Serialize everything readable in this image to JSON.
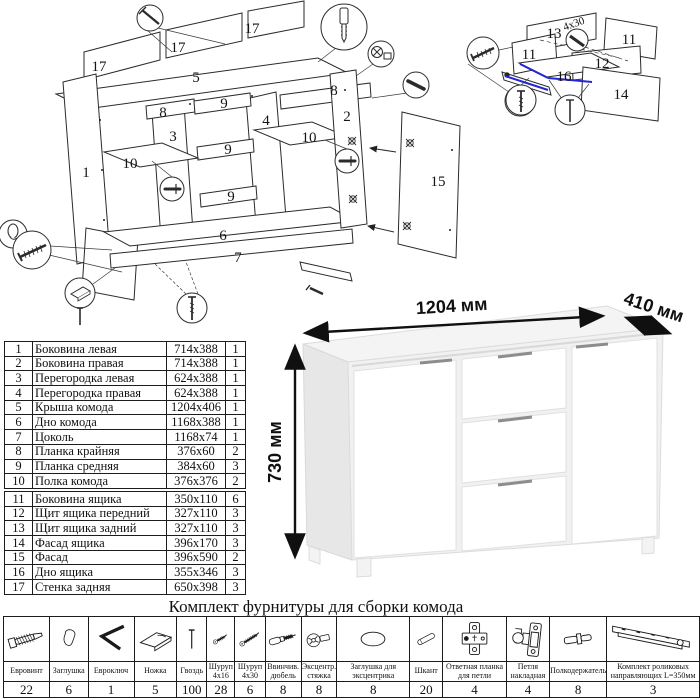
{
  "assembly_diagram": {
    "labels": {
      "back_panel_a": "17",
      "back_panel_b": "17",
      "back_panel_c": "17",
      "top_panel": "5",
      "left_side": "1",
      "right_side": "2",
      "partition_left": "3",
      "partition_right": "4",
      "rail_outer_left": "8",
      "rail_outer_right": "8",
      "rail_mid_1": "9",
      "rail_mid_2": "9",
      "rail_mid_3": "9",
      "shelf_left": "10",
      "shelf_right": "10",
      "bottom_panel": "6",
      "plinth": "7",
      "door": "15"
    }
  },
  "drawer_diagram": {
    "labels": {
      "back": "13",
      "side_left": "11",
      "side_right": "11",
      "front": "12",
      "bottom": "16",
      "facade": "14"
    },
    "screw_size_note": "4x30"
  },
  "dimension_drawing": {
    "width": "1204 мм",
    "depth": "410 мм",
    "height": "730 мм"
  },
  "parts_table": {
    "rows": [
      {
        "num": "1",
        "name": "Боковина левая",
        "size": "714x388",
        "qty": "1"
      },
      {
        "num": "2",
        "name": "Боковина правая",
        "size": "714x388",
        "qty": "1"
      },
      {
        "num": "3",
        "name": "Перегородка левая",
        "size": "624x388",
        "qty": "1"
      },
      {
        "num": "4",
        "name": "Перегородка правая",
        "size": "624x388",
        "qty": "1"
      },
      {
        "num": "5",
        "name": "Крыша комода",
        "size": "1204x406",
        "qty": "1"
      },
      {
        "num": "6",
        "name": "Дно комода",
        "size": "1168x388",
        "qty": "1"
      },
      {
        "num": "7",
        "name": "Цоколь",
        "size": "1168x74",
        "qty": "1"
      },
      {
        "num": "8",
        "name": "Планка крайняя",
        "size": "376x60",
        "qty": "2"
      },
      {
        "num": "9",
        "name": "Планка средняя",
        "size": "384x60",
        "qty": "3"
      },
      {
        "num": "10",
        "name": "Полка комода",
        "size": "376x376",
        "qty": "2"
      },
      {
        "num": "11",
        "name": "Боковина ящика",
        "size": "350x110",
        "qty": "6"
      },
      {
        "num": "12",
        "name": "Щит ящика передний",
        "size": "327x110",
        "qty": "3"
      },
      {
        "num": "13",
        "name": "Щит ящика задний",
        "size": "327x110",
        "qty": "3"
      },
      {
        "num": "14",
        "name": "Фасад ящика",
        "size": "396x170",
        "qty": "3"
      },
      {
        "num": "15",
        "name": "Фасад",
        "size": "396x590",
        "qty": "2"
      },
      {
        "num": "16",
        "name": "Дно ящика",
        "size": "355x346",
        "qty": "3"
      },
      {
        "num": "17",
        "name": "Стенка задняя",
        "size": "650x398",
        "qty": "3"
      }
    ]
  },
  "hardware": {
    "title": "Комплект фурнитуры для сборки комода",
    "items": [
      {
        "name": "Евровинт",
        "qty": "22",
        "icon": "confirmat-screw"
      },
      {
        "name": "Заглушка",
        "qty": "6",
        "icon": "cap"
      },
      {
        "name": "Евроключ",
        "qty": "1",
        "icon": "hex-key"
      },
      {
        "name": "Ножка",
        "qty": "5",
        "icon": "foot"
      },
      {
        "name": "Гвоздь",
        "qty": "100",
        "icon": "nail"
      },
      {
        "name": "Шуруп 4x16",
        "qty": "28",
        "icon": "screw-small"
      },
      {
        "name": "Шуруп 4x30",
        "qty": "6",
        "icon": "screw-large"
      },
      {
        "name": "Ввинчив. дюбель",
        "qty": "8",
        "icon": "threaded-dowel"
      },
      {
        "name": "Эксцентр. стяжка",
        "qty": "8",
        "icon": "cam-lock"
      },
      {
        "name": "Заглушка для эксцентрика",
        "qty": "8",
        "icon": "cam-cap"
      },
      {
        "name": "Шкант",
        "qty": "20",
        "icon": "wood-dowel"
      },
      {
        "name": "Ответная планка для петли",
        "qty": "4",
        "icon": "hinge-plate"
      },
      {
        "name": "Петля накладная",
        "qty": "4",
        "icon": "hinge"
      },
      {
        "name": "Полкодержатель",
        "qty": "8",
        "icon": "shelf-pin"
      },
      {
        "name": "Комплект роликовых направляющих L=350мм",
        "qty": "3",
        "icon": "drawer-slide"
      }
    ]
  },
  "colors": {
    "accent_blue": "#2525d8",
    "line": "#2b2b2b"
  }
}
